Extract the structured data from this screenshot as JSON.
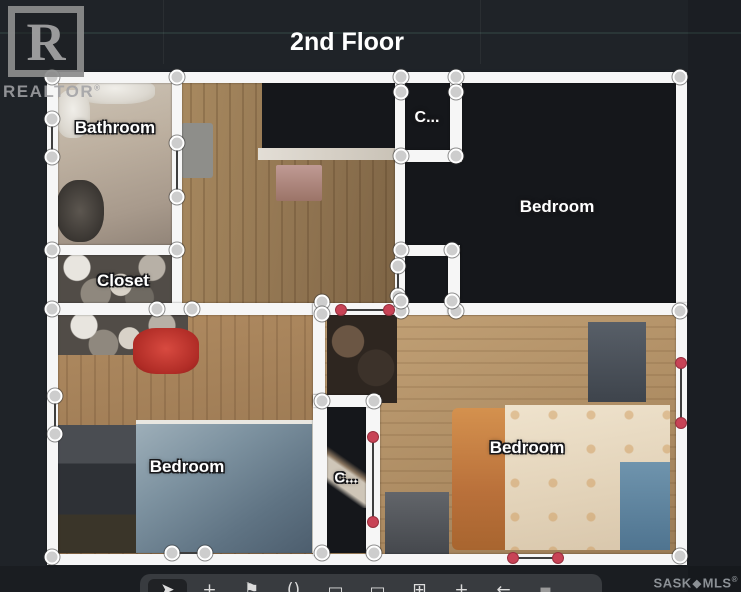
{
  "title": "2nd Floor",
  "watermark": {
    "logo_letter": "R",
    "brand": "REALTOR",
    "reg": "®"
  },
  "footer_brand": {
    "text1": "SASK",
    "diamond": "◆",
    "text2": "MLS",
    "reg": "®"
  },
  "colors": {
    "background": "#1f2328",
    "wall_white": "#f6f6f6",
    "node_fill": "#cdcdcd",
    "door_marker_red": "#c84356",
    "unscanned_room": "#15171b",
    "label_text": "#ffffff",
    "toolbar_bg": "#383b3f",
    "watermark_grey": "#a2a2a5"
  },
  "plan": {
    "labels": [
      {
        "text": "Bathroom",
        "x": 115,
        "y": 128,
        "size": 17
      },
      {
        "text": "C...",
        "x": 427,
        "y": 118,
        "size": 16
      },
      {
        "text": "Bedroom",
        "x": 557,
        "y": 207,
        "size": 17
      },
      {
        "text": "Closet",
        "x": 123,
        "y": 281,
        "size": 17
      },
      {
        "text": "Bedroom",
        "x": 187,
        "y": 467,
        "size": 17
      },
      {
        "text": "C...",
        "x": 346,
        "y": 478,
        "size": 15
      },
      {
        "text": "Bedroom",
        "x": 527,
        "y": 448,
        "size": 17
      }
    ],
    "floors": [
      {
        "x": 52,
        "y": 77,
        "w": 125,
        "h": 173,
        "kind": "tile",
        "name": "bathroom-floor"
      },
      {
        "x": 75,
        "y": 78,
        "w": 80,
        "h": 26,
        "kind": "blob-white",
        "name": "bathroom-fixture"
      },
      {
        "x": 56,
        "y": 90,
        "w": 34,
        "h": 48,
        "kind": "blob-white",
        "name": "bathroom-sink"
      },
      {
        "x": 56,
        "y": 180,
        "w": 48,
        "h": 62,
        "kind": "blob-dark",
        "name": "bathroom-clutter"
      },
      {
        "x": 52,
        "y": 250,
        "w": 125,
        "h": 58,
        "kind": "clutter",
        "name": "closet-contents"
      },
      {
        "x": 177,
        "y": 77,
        "w": 223,
        "h": 231,
        "kind": "wood-hall",
        "name": "hallway-floor"
      },
      {
        "x": 262,
        "y": 80,
        "w": 136,
        "h": 70,
        "kind": "dark",
        "name": "hallway-unscanned-area"
      },
      {
        "x": 258,
        "y": 148,
        "w": 140,
        "h": 12,
        "kind": "shelf",
        "name": "hallway-ledge"
      },
      {
        "x": 181,
        "y": 123,
        "w": 32,
        "h": 55,
        "kind": "mat",
        "name": "hallway-mat"
      },
      {
        "x": 276,
        "y": 165,
        "w": 46,
        "h": 36,
        "kind": "table",
        "name": "hallway-table"
      },
      {
        "x": 400,
        "y": 80,
        "w": 278,
        "h": 230,
        "kind": "dark",
        "name": "bedroom-top-right-unscanned"
      },
      {
        "x": 52,
        "y": 310,
        "w": 263,
        "h": 246,
        "kind": "wood",
        "name": "bedroom-left-floor"
      },
      {
        "x": 58,
        "y": 313,
        "w": 130,
        "h": 42,
        "kind": "clutter",
        "name": "bedroom-left-clutter"
      },
      {
        "x": 133,
        "y": 328,
        "w": 66,
        "h": 46,
        "kind": "red-item",
        "name": "red-jacket"
      },
      {
        "x": 54,
        "y": 425,
        "w": 88,
        "h": 128,
        "kind": "furniture-dark",
        "name": "dresser"
      },
      {
        "x": 136,
        "y": 420,
        "w": 180,
        "h": 133,
        "kind": "bed-blue",
        "name": "bed-left"
      },
      {
        "x": 325,
        "y": 310,
        "w": 353,
        "h": 246,
        "kind": "wood-light",
        "name": "bedroom-right-floor"
      },
      {
        "x": 327,
        "y": 315,
        "w": 70,
        "h": 88,
        "kind": "clutter-brown",
        "name": "bedroom-right-clutter"
      },
      {
        "x": 588,
        "y": 322,
        "w": 58,
        "h": 80,
        "kind": "nightstand",
        "name": "nightstand"
      },
      {
        "x": 452,
        "y": 408,
        "w": 58,
        "h": 142,
        "kind": "pillow-orange",
        "name": "bed-right-pillow"
      },
      {
        "x": 505,
        "y": 405,
        "w": 165,
        "h": 145,
        "kind": "bed-cream",
        "name": "bed-right"
      },
      {
        "x": 620,
        "y": 462,
        "w": 50,
        "h": 88,
        "kind": "blue-item",
        "name": "blue-blanket"
      },
      {
        "x": 385,
        "y": 492,
        "w": 64,
        "h": 62,
        "kind": "desk",
        "name": "desk-chair"
      },
      {
        "x": 325,
        "y": 405,
        "w": 43,
        "h": 148,
        "kind": "dark",
        "name": "closet-bottom-floor"
      },
      {
        "x": 327,
        "y": 438,
        "w": 40,
        "h": 70,
        "kind": "shelf-diag",
        "name": "closet-bottom-shelf"
      }
    ],
    "walls": [
      [
        47,
        72,
        640,
        11
      ],
      [
        47,
        72,
        11,
        493
      ],
      [
        676,
        72,
        11,
        493
      ],
      [
        47,
        554,
        640,
        11
      ],
      [
        172,
        72,
        10,
        243
      ],
      [
        47,
        245,
        135,
        10
      ],
      [
        47,
        303,
        275,
        12
      ],
      [
        313,
        303,
        374,
        12
      ],
      [
        313,
        303,
        12,
        102
      ],
      [
        395,
        72,
        10,
        243
      ],
      [
        450,
        83,
        12,
        79
      ],
      [
        395,
        150,
        67,
        12
      ],
      [
        400,
        245,
        60,
        11
      ],
      [
        448,
        245,
        12,
        70
      ],
      [
        313,
        395,
        14,
        160
      ],
      [
        366,
        395,
        14,
        160
      ],
      [
        313,
        395,
        67,
        12
      ]
    ],
    "doors_grey": [
      [
        52,
        119,
        52,
        157
      ],
      [
        177,
        143,
        177,
        197
      ],
      [
        398,
        266,
        398,
        296
      ],
      [
        55,
        396,
        55,
        434
      ],
      [
        172,
        553,
        205,
        553
      ]
    ],
    "doors_red": [
      [
        341,
        310,
        389,
        310
      ],
      [
        681,
        363,
        681,
        423
      ],
      [
        373,
        437,
        373,
        522
      ],
      [
        513,
        558,
        558,
        558
      ]
    ],
    "nodes": [
      [
        52,
        77
      ],
      [
        177,
        77
      ],
      [
        401,
        77
      ],
      [
        456,
        77
      ],
      [
        680,
        77
      ],
      [
        52,
        119
      ],
      [
        52,
        157
      ],
      [
        52,
        250
      ],
      [
        177,
        143
      ],
      [
        177,
        197
      ],
      [
        177,
        250
      ],
      [
        52,
        309
      ],
      [
        157,
        309
      ],
      [
        192,
        309
      ],
      [
        322,
        302
      ],
      [
        322,
        314
      ],
      [
        401,
        311
      ],
      [
        456,
        311
      ],
      [
        680,
        311
      ],
      [
        401,
        92
      ],
      [
        456,
        92
      ],
      [
        401,
        156
      ],
      [
        456,
        156
      ],
      [
        401,
        250
      ],
      [
        452,
        250
      ],
      [
        398,
        266
      ],
      [
        398,
        296
      ],
      [
        401,
        301
      ],
      [
        452,
        301
      ],
      [
        55,
        396
      ],
      [
        55,
        434
      ],
      [
        322,
        401
      ],
      [
        374,
        401
      ],
      [
        322,
        553
      ],
      [
        374,
        553
      ],
      [
        52,
        557
      ],
      [
        172,
        553
      ],
      [
        205,
        553
      ],
      [
        680,
        556
      ]
    ]
  },
  "toolbar": {
    "items": [
      {
        "name": "select-tool",
        "glyph": "➤",
        "active": true
      },
      {
        "name": "add-point-tool",
        "glyph": "+"
      },
      {
        "name": "flag-tool",
        "glyph": "⚑"
      },
      {
        "name": "parentheses-tool",
        "glyph": "()"
      },
      {
        "name": "rectangle-tool",
        "glyph": "▭"
      },
      {
        "name": "rectangle-tool-2",
        "glyph": "▭"
      },
      {
        "name": "grid-tool",
        "glyph": "⊞"
      },
      {
        "name": "add-tool-2",
        "glyph": "+"
      },
      {
        "name": "undo-tool",
        "glyph": "←"
      },
      {
        "name": "color-swatch",
        "glyph": "■"
      }
    ]
  }
}
